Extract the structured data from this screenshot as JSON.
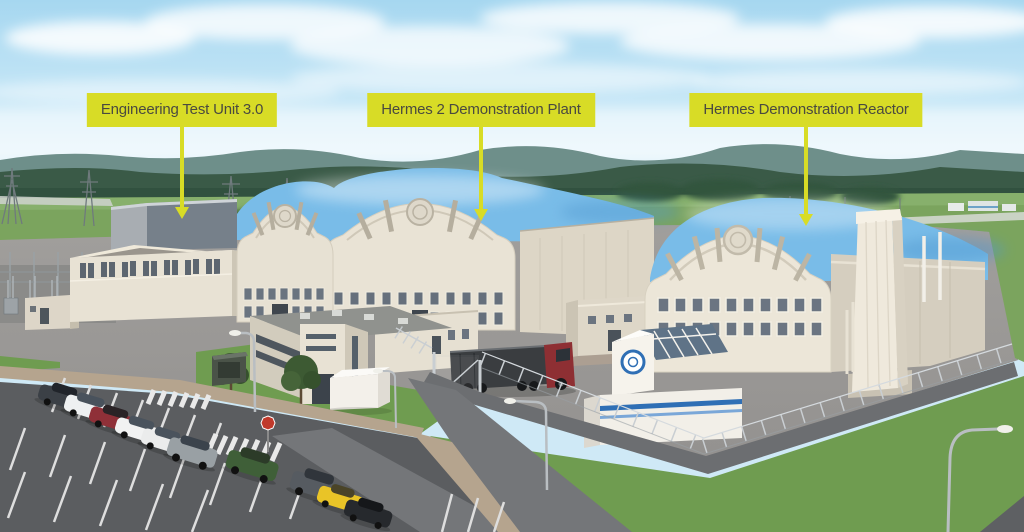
{
  "scene": {
    "description": "Aerial 3D rendering of a nuclear demonstration facility campus with three labeled buildings",
    "labels": [
      {
        "id": "etu",
        "text": "Engineering Test Unit 3.0"
      },
      {
        "id": "hermes2",
        "text": "Hermes 2 Demonstration Plant"
      },
      {
        "id": "hermes",
        "text": "Hermes Demonstration Reactor"
      }
    ]
  },
  "colors": {
    "label_bg": "#d8dc26",
    "label_text": "#4a4a40",
    "arrow": "#d8dc26",
    "sky_top": "#a6d7f0",
    "sky_horizon": "#e9f6fc",
    "hills": "#6e8f8a",
    "forest": "#3a5a47",
    "field": "#7ba45e",
    "grass": "#6f9c50",
    "pad": "#9b9997",
    "road": "#6c6e71",
    "parking": "#5b5d60",
    "lane": "#747679",
    "tan_path": "#b5a48e",
    "building_cream": "#e8e2d4",
    "building_shade": "#cdc6b6",
    "building_gray": "#76808a",
    "roof_blue": "#79bce8",
    "roof_blue_deep": "#4f97cf",
    "truck_red": "#8e2f33",
    "trailer_gray": "#3a3d40",
    "stop_sign_red": "#c0392b",
    "visitor_blue": "#2f6fb5",
    "fence_gray": "#c9ced2"
  },
  "cars": [
    {
      "color": "#3b4046",
      "type": "sedan"
    },
    {
      "color": "#eef0f1",
      "type": "suv"
    },
    {
      "color": "#8f3038",
      "type": "sedan"
    },
    {
      "color": "#f1f2f2",
      "type": "sedan"
    },
    {
      "color": "#ebecec",
      "type": "sedan"
    },
    {
      "color": "#99a0a4",
      "type": "suv"
    },
    {
      "color": "#3f5f38",
      "type": "suv"
    },
    {
      "color": "#565b61",
      "type": "suv"
    },
    {
      "color": "#e9c427",
      "type": "hatchback"
    },
    {
      "color": "#26292d",
      "type": "sedan"
    }
  ]
}
